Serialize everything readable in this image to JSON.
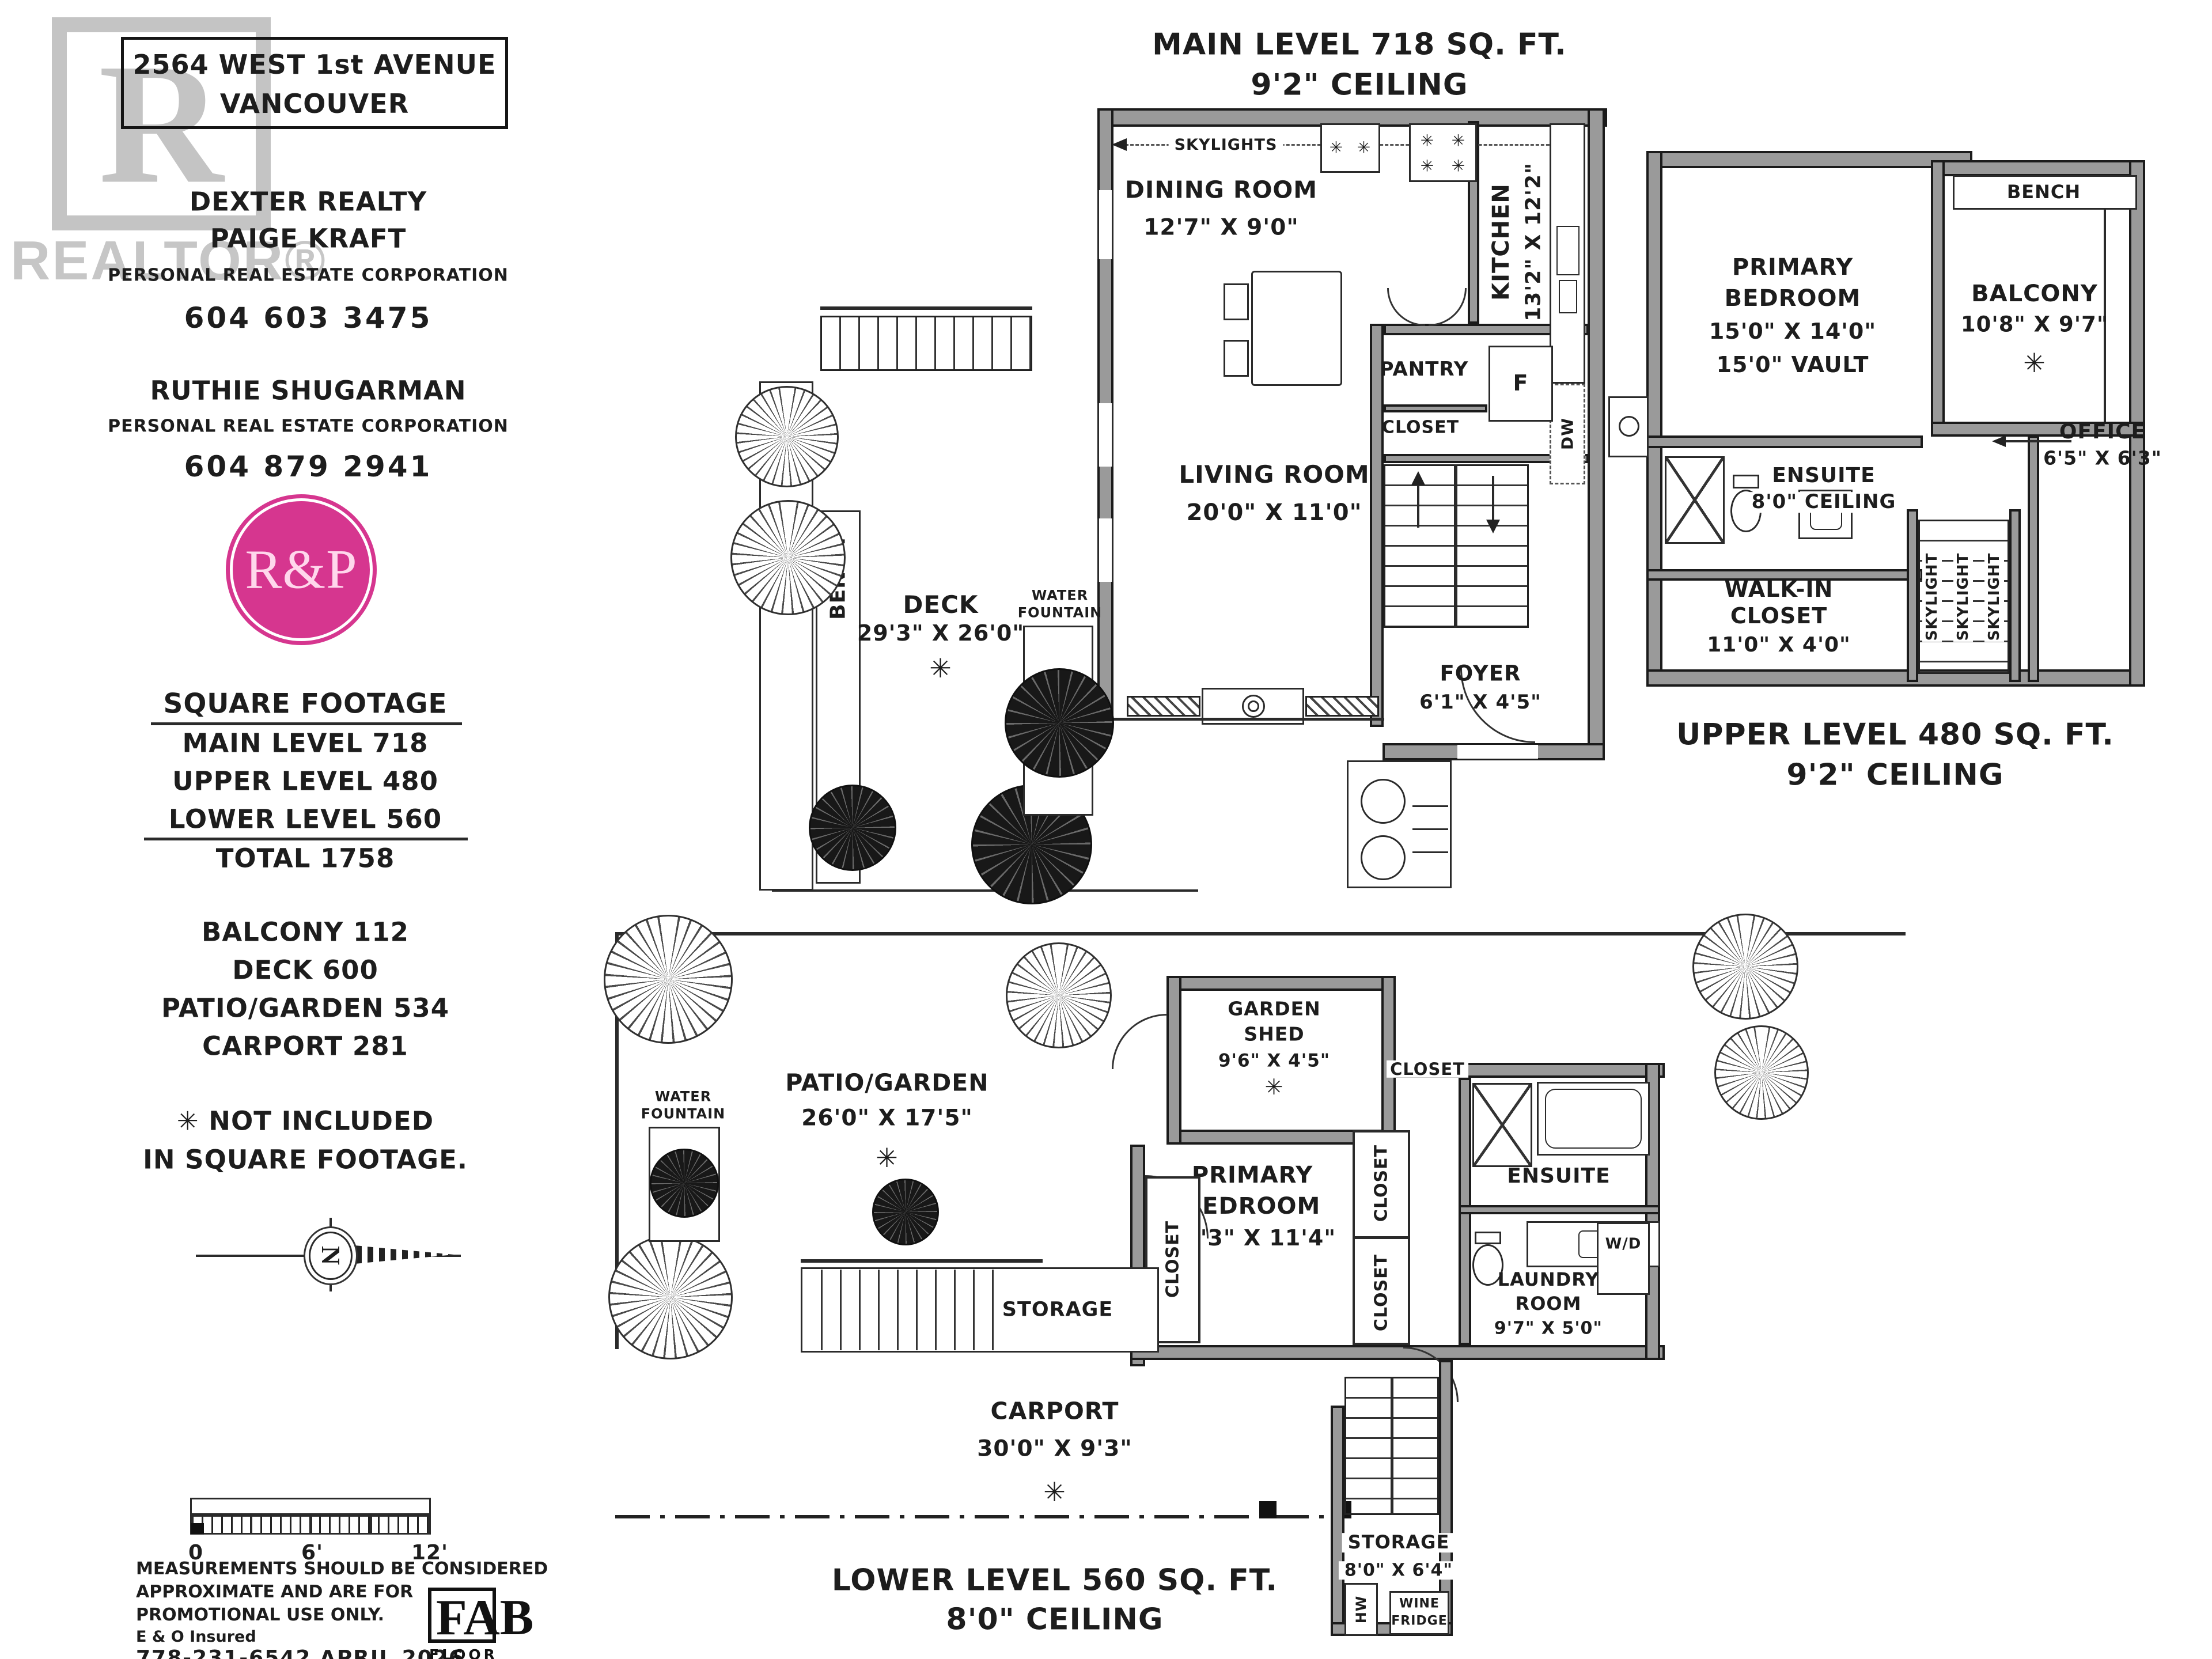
{
  "shared": {
    "asterisk": "✳"
  },
  "info_panel": {
    "watermark_r": "R",
    "watermark_word": "REALTOR®",
    "address_line1": "2564 WEST 1st AVENUE",
    "address_line2": "VANCOUVER",
    "brokerage": "DEXTER REALTY",
    "agent1_name": "PAIGE KRAFT",
    "agent1_title": "PERSONAL REAL ESTATE CORPORATION",
    "agent1_phone": "604 603 3475",
    "agent2_name": "RUTHIE SHUGARMAN",
    "agent2_title": "PERSONAL REAL ESTATE CORPORATION",
    "agent2_phone": "604 879 2941",
    "logo_monogram": "R&P",
    "logo_color": "#d6368f",
    "sqft_heading": "SQUARE FOOTAGE",
    "sqft_main": "MAIN LEVEL 718",
    "sqft_upper": "UPPER LEVEL 480",
    "sqft_lower": "LOWER LEVEL 560",
    "sqft_total": "TOTAL 1758",
    "extra_balcony": "BALCONY 112",
    "extra_deck": "DECK 600",
    "extra_patio": "PATIO/GARDEN 534",
    "extra_carport": "CARPORT 281",
    "not_included_1": "✳ NOT INCLUDED",
    "not_included_2": "IN SQUARE FOOTAGE.",
    "compass_letter": "N"
  },
  "scale_bar": {
    "t0": "0",
    "t6": "6'",
    "t12": "12'"
  },
  "footer": {
    "disclaimer1": "MEASUREMENTS SHOULD BE CONSIDERED",
    "disclaimer2": "APPROXIMATE AND ARE FOR",
    "disclaimer3": "PROMOTIONAL USE ONLY.",
    "insured": "E & O Insured",
    "phone_date": "778-231-6542  APRIL 2026",
    "fab_logo": "FAB",
    "fab_sub": "FLOOR PLANS"
  },
  "main_level": {
    "title1": "MAIN LEVEL 718 SQ. FT.",
    "title2": "9'2\" CEILING",
    "skylights": "SKYLIGHTS",
    "dining": "DINING ROOM",
    "dining_dim": "12'7\" X 9'0\"",
    "kitchen": "KITCHEN",
    "kitchen_dim": "13'2\" X 12'2\"",
    "pantry": "PANTRY",
    "fridge": "F",
    "dw": "DW",
    "closet": "CLOSET",
    "living": "LIVING ROOM",
    "living_dim": "20'0\" X 11'0\"",
    "water1": "WATER",
    "water2": "FOUNTAIN",
    "deck": "DECK",
    "deck_dim": "29'3\" X 26'0\"",
    "bench": "BENCH",
    "foyer": "FOYER",
    "foyer_dim": "6'1\" X 4'5\""
  },
  "upper_level": {
    "title1": "UPPER LEVEL 480 SQ. FT.",
    "title2": "9'2\" CEILING",
    "bench": "BENCH",
    "balcony": "BALCONY",
    "balcony_dim": "10'8\" X 9'7\"",
    "bedroom1": "PRIMARY",
    "bedroom2": "BEDROOM",
    "bedroom_dim": "15'0\" X 14'0\"",
    "bedroom_vault": "15'0\" VAULT",
    "office": "OFFICE",
    "office_dim": "6'5\" X 6'3\"",
    "ensuite": "ENSUITE",
    "ensuite_ceiling": "8'0\" CEILING",
    "walkin1": "WALK-IN",
    "walkin2": "CLOSET",
    "walkin_dim": "11'0\" X 4'0\"",
    "skylight": "SKYLIGHT"
  },
  "lower_level": {
    "title1": "LOWER LEVEL 560 SQ. FT.",
    "title2": "8'0\" CEILING",
    "garden_shed1": "GARDEN",
    "garden_shed2": "SHED",
    "garden_shed_dim": "9'6\" X 4'5\"",
    "patio": "PATIO/GARDEN",
    "patio_dim": "26'0\" X 17'5\"",
    "water1": "WATER",
    "water2": "FOUNTAIN",
    "bedroom1": "PRIMARY",
    "bedroom2": "BEDROOM",
    "bedroom_dim": "14'3\" X 11'4\"",
    "closet": "CLOSET",
    "ensuite": "ENSUITE",
    "laundry1": "LAUNDRY",
    "laundry2": "ROOM",
    "laundry_dim": "9'7\" X 5'0\"",
    "wd": "W/D",
    "storage_understairs": "STORAGE",
    "carport": "CARPORT",
    "carport_dim": "30'0\" X 9'3\"",
    "storage2": "STORAGE",
    "storage2_dim": "8'0\" X 6'4\"",
    "wine1": "WINE",
    "wine2": "FRIDGE",
    "hw": "HW"
  }
}
